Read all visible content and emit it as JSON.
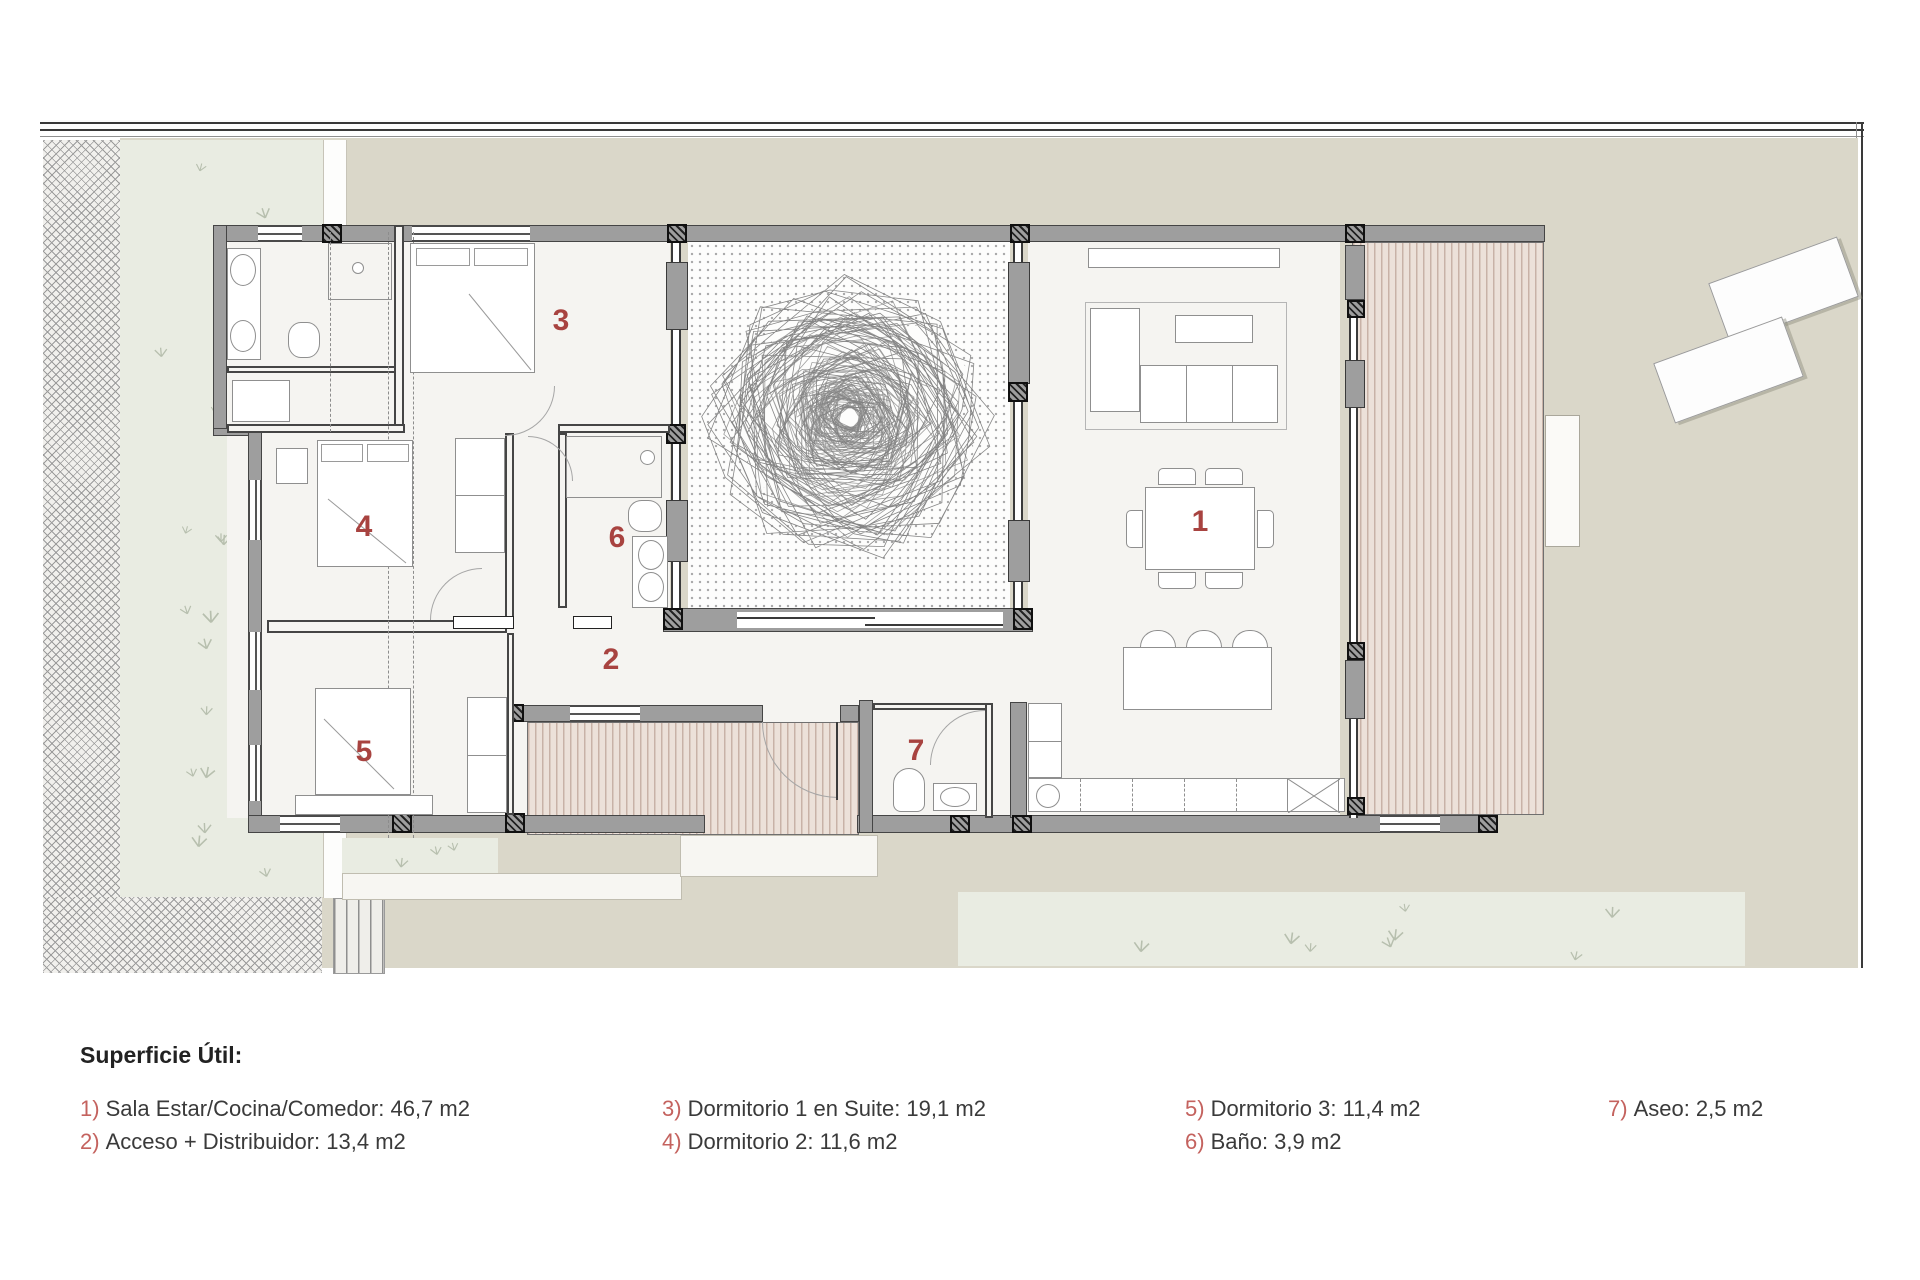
{
  "legend": {
    "title": "Superficie Útil:",
    "entries": [
      {
        "num": "1)",
        "text": "Sala Estar/Cocina/Comedor: 46,7 m2"
      },
      {
        "num": "2)",
        "text": "Acceso + Distribuidor: 13,4 m2"
      },
      {
        "num": "3)",
        "text": "Dormitorio 1 en Suite: 19,1 m2"
      },
      {
        "num": "4)",
        "text": "Dormitorio 2: 11,6 m2"
      },
      {
        "num": "5)",
        "text": "Dormitorio 3: 11,4 m2"
      },
      {
        "num": "6)",
        "text": "Baño: 3,9 m2"
      },
      {
        "num": "7)",
        "text": "Aseo: 2,5 m2"
      }
    ]
  },
  "rooms": [
    {
      "num": "1"
    },
    {
      "num": "2"
    },
    {
      "num": "3"
    },
    {
      "num": "4"
    },
    {
      "num": "5"
    },
    {
      "num": "6"
    },
    {
      "num": "7"
    }
  ],
  "colors": {
    "room_number": "#a84340",
    "legend_number": "#c4625e",
    "text": "#3a3a3a",
    "wall": "#9e9e9e",
    "wall_edge": "#454545",
    "site": "#dad7c9",
    "lawn": "#e9ece2",
    "lawn_mark": "#b7bfae",
    "deck": "#ece1d9",
    "deck_line": "#c8b2a7",
    "floor": "#f5f4f1",
    "courtyard_dot": "#a8a8a8",
    "pavement": "#f1f0ed",
    "pavement_line": "#9b9b9b",
    "tree_stroke": "#808080"
  }
}
